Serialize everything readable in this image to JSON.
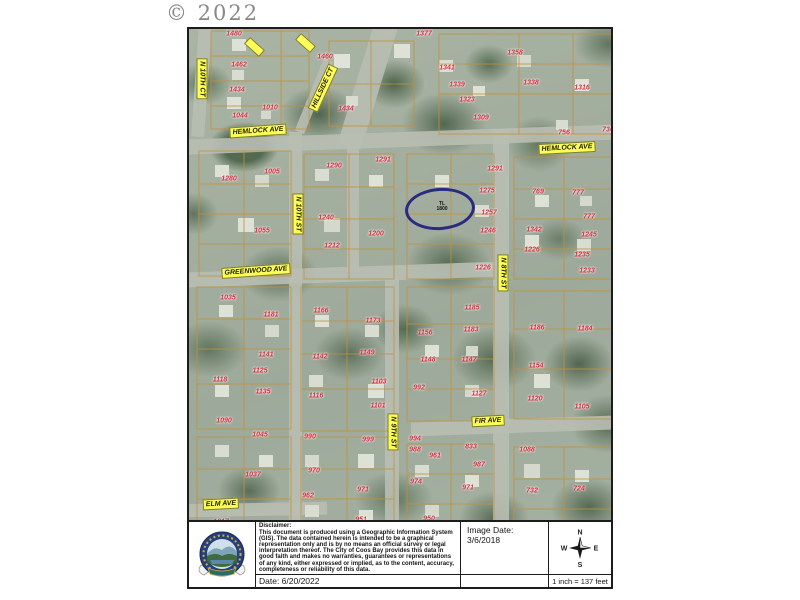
{
  "stamp": {
    "copyright": "© 2022"
  },
  "map": {
    "street_labels": [
      {
        "text": "N 10TH CT",
        "x": 13,
        "y": 50,
        "rot": 90
      },
      {
        "text": "HILLSIDE CT",
        "x": 134,
        "y": 59,
        "rot": -65
      },
      {
        "text": "HEMLOCK AVE",
        "x": 69,
        "y": 102,
        "rot": -4
      },
      {
        "text": "HEMLOCK AVE",
        "x": 378,
        "y": 119,
        "rot": -3
      },
      {
        "text": "GREENWOOD AVE",
        "x": 67,
        "y": 242,
        "rot": -4
      },
      {
        "text": "N 10TH ST",
        "x": 109,
        "y": 185,
        "rot": 90
      },
      {
        "text": "N 8TH ST",
        "x": 314,
        "y": 244,
        "rot": 90
      },
      {
        "text": "N 9TH ST",
        "x": 204,
        "y": 403,
        "rot": 90
      },
      {
        "text": "FIR AVE",
        "x": 299,
        "y": 392,
        "rot": -3
      },
      {
        "text": "ELM AVE",
        "x": 32,
        "y": 475,
        "rot": -3
      }
    ],
    "parcels": [
      [
        "1480",
        45,
        5
      ],
      [
        "1462",
        50,
        36
      ],
      [
        "1434",
        48,
        61
      ],
      [
        "1044",
        51,
        87
      ],
      [
        "1010",
        81,
        79
      ],
      [
        "1460",
        136,
        28
      ],
      [
        "1434",
        157,
        80
      ],
      [
        "1377",
        235,
        5
      ],
      [
        "1341",
        258,
        39
      ],
      [
        "1339",
        268,
        56
      ],
      [
        "1323",
        278,
        71
      ],
      [
        "1309",
        292,
        89
      ],
      [
        "1358",
        326,
        24
      ],
      [
        "1338",
        342,
        54
      ],
      [
        "1316",
        393,
        59
      ],
      [
        "756",
        375,
        104
      ],
      [
        "736",
        419,
        101
      ],
      [
        "1280",
        40,
        150
      ],
      [
        "1005",
        83,
        143
      ],
      [
        "1055",
        73,
        202
      ],
      [
        "1035",
        39,
        269
      ],
      [
        "1290",
        145,
        137
      ],
      [
        "1291",
        194,
        131
      ],
      [
        "1240",
        137,
        189
      ],
      [
        "1212",
        143,
        217
      ],
      [
        "1200",
        187,
        205
      ],
      [
        "1291",
        306,
        140
      ],
      [
        "1275",
        298,
        162
      ],
      [
        "1257",
        300,
        184
      ],
      [
        "1246",
        299,
        202
      ],
      [
        "1226",
        294,
        239
      ],
      [
        "769",
        349,
        163
      ],
      [
        "777",
        389,
        164
      ],
      [
        "777",
        400,
        188
      ],
      [
        "1342",
        345,
        201
      ],
      [
        "1245",
        400,
        206
      ],
      [
        "1226",
        343,
        221
      ],
      [
        "1235",
        393,
        226
      ],
      [
        "1233",
        398,
        242
      ],
      [
        "1181",
        82,
        286
      ],
      [
        "1166",
        132,
        282
      ],
      [
        "1173",
        184,
        292
      ],
      [
        "1156",
        236,
        304
      ],
      [
        "1185",
        283,
        279
      ],
      [
        "1183",
        282,
        301
      ],
      [
        "1186",
        348,
        299
      ],
      [
        "1184",
        396,
        300
      ],
      [
        "1141",
        77,
        326
      ],
      [
        "1142",
        131,
        328
      ],
      [
        "1149",
        178,
        324
      ],
      [
        "1148",
        239,
        331
      ],
      [
        "1147",
        280,
        331
      ],
      [
        "1154",
        347,
        337
      ],
      [
        "1125",
        71,
        342
      ],
      [
        "1135",
        74,
        363
      ],
      [
        "1118",
        31,
        351
      ],
      [
        "1116",
        127,
        367
      ],
      [
        "1103",
        190,
        353
      ],
      [
        "1101",
        189,
        377
      ],
      [
        "992",
        230,
        359
      ],
      [
        "1127",
        290,
        365
      ],
      [
        "1120",
        346,
        370
      ],
      [
        "1105",
        393,
        378
      ],
      [
        "1090",
        35,
        392
      ],
      [
        "1045",
        71,
        406
      ],
      [
        "990",
        121,
        408
      ],
      [
        "999",
        179,
        411
      ],
      [
        "994",
        226,
        410
      ],
      [
        "988",
        226,
        421
      ],
      [
        "961",
        246,
        427
      ],
      [
        "833",
        282,
        418
      ],
      [
        "987",
        290,
        436
      ],
      [
        "1088",
        338,
        421
      ],
      [
        "1037",
        64,
        446
      ],
      [
        "970",
        125,
        442
      ],
      [
        "974",
        227,
        453
      ],
      [
        "971",
        279,
        459
      ],
      [
        "962",
        119,
        467
      ],
      [
        "971",
        174,
        461
      ],
      [
        "1017",
        32,
        493
      ],
      [
        "951",
        172,
        491
      ],
      [
        "950",
        240,
        490
      ],
      [
        "732",
        343,
        462
      ],
      [
        "724",
        390,
        460
      ]
    ],
    "tl_labels": [
      {
        "lines": [
          "TL",
          "1800"
        ],
        "x": 253,
        "y": 178
      }
    ],
    "annotation_circle": {
      "x": 251,
      "y": 180,
      "rx": 32,
      "ry": 18,
      "color": "#2a2a80"
    }
  },
  "footer": {
    "disclaimer_title": "Disclaimer:",
    "disclaimer_body": "This document is produced using a Geographic Information System (GIS). The data contained herein is intended to be a graphical representation only and is by no means an official survey or legal interpretation thereof. The City of Coos Bay provides this data in good faith and makes no warranties, guarantees or representations of any kind, either expressed or implied, as to the content, accuracy, completeness or reliability of this data.",
    "date": "Date: 6/20/2022",
    "image_date": "Image Date: 3/6/2018",
    "scale": "1 inch = 137 feet",
    "compass": {
      "n": "N",
      "e": "E",
      "s": "S",
      "w": "W"
    }
  }
}
